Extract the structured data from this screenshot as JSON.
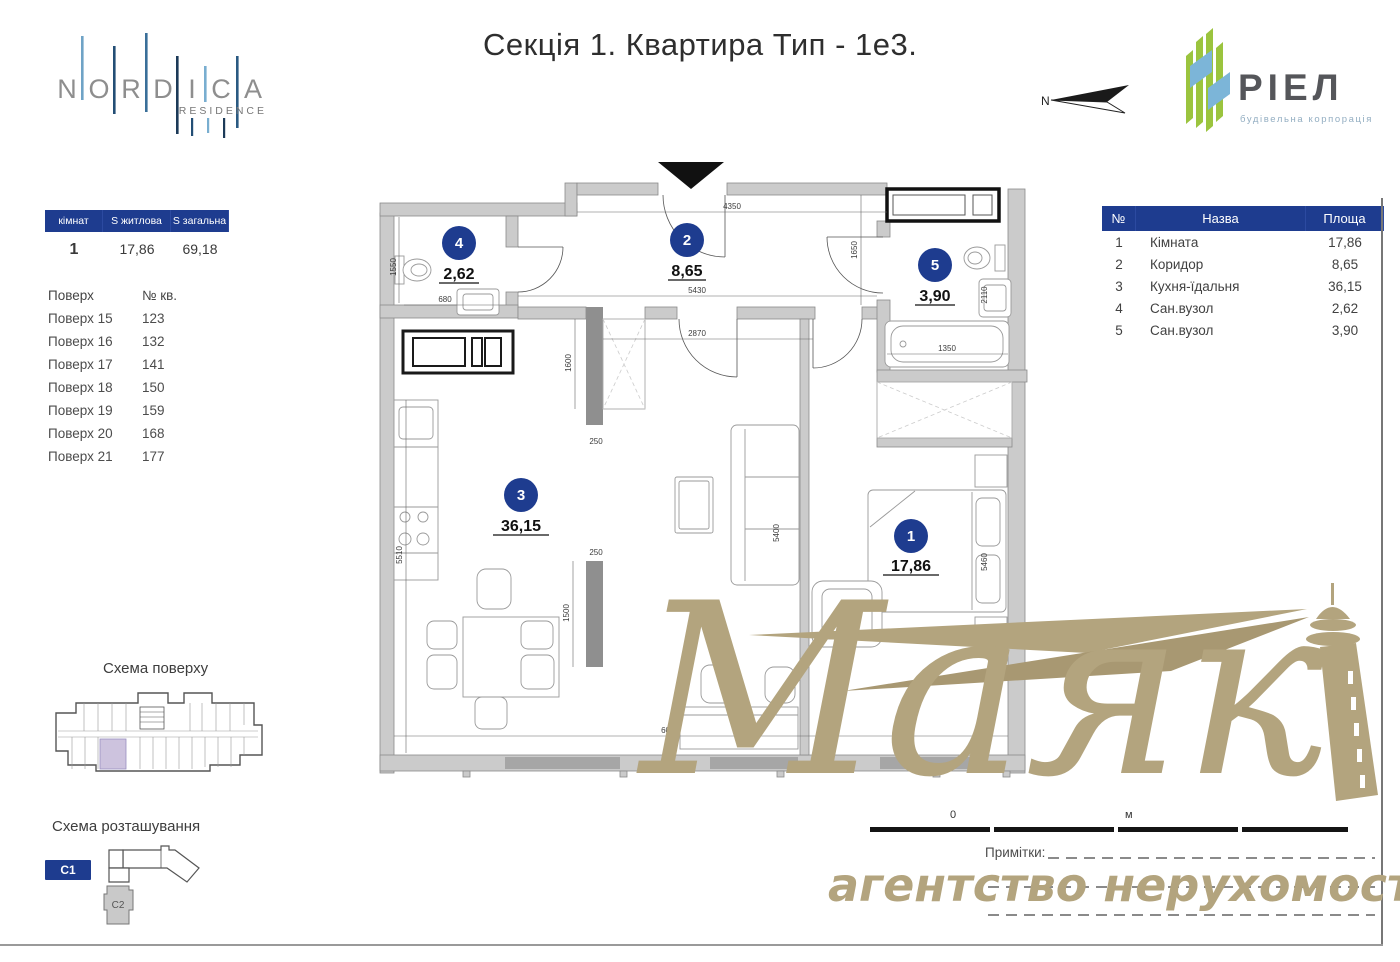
{
  "title": "Секція 1. Квартира Тип - 1е3.",
  "brand": {
    "nordica": {
      "letters": [
        "N",
        "O",
        "R",
        "D",
        "I",
        "C",
        "A"
      ],
      "sub": "RESIDENCE"
    },
    "riel": {
      "name": "РІЕЛ",
      "sub": "будівельна корпорація"
    },
    "compass": "N"
  },
  "summary": {
    "headers": [
      "кімнат",
      "S житлова",
      "S загальна"
    ],
    "row": [
      "1",
      "17,86",
      "69,18"
    ]
  },
  "floors": {
    "col1": "Поверх",
    "col2": "№ кв.",
    "rows": [
      [
        "Поверх 15",
        "123"
      ],
      [
        "Поверх 16",
        "132"
      ],
      [
        "Поверх 17",
        "141"
      ],
      [
        "Поверх 18",
        "150"
      ],
      [
        "Поверх 19",
        "159"
      ],
      [
        "Поверх 20",
        "168"
      ],
      [
        "Поверх 21",
        "177"
      ]
    ]
  },
  "rooms": {
    "headers": [
      "№",
      "Назва",
      "Площа"
    ],
    "rows": [
      [
        "1",
        "Кімната",
        "17,86"
      ],
      [
        "2",
        "Коридор",
        "8,65"
      ],
      [
        "3",
        "Кухня-їдальня",
        "36,15"
      ],
      [
        "4",
        "Сан.вузол",
        "2,62"
      ],
      [
        "5",
        "Сан.вузол",
        "3,90"
      ]
    ]
  },
  "plan": {
    "badges": [
      {
        "n": "1",
        "area": "17,86"
      },
      {
        "n": "2",
        "area": "8,65"
      },
      {
        "n": "3",
        "area": "36,15"
      },
      {
        "n": "4",
        "area": "2,62"
      },
      {
        "n": "5",
        "area": "3,90"
      }
    ],
    "dims": {
      "top": "4350",
      "corridor": "5430",
      "hall": "2870",
      "wc4_h": "1550",
      "wc4_w": "680",
      "wc5_h": "1650",
      "wc5_w": "2110",
      "bath": "1350",
      "ward_h": "1600",
      "stub1": "250",
      "stub2": "250",
      "stub_h": "1500",
      "kitchen_h": "5510",
      "living_h": "5400",
      "room1_h": "5460",
      "bottom": "6020"
    },
    "scale": {
      "zero": "0",
      "unit": "м"
    }
  },
  "schemes": {
    "floor_title": "Схема поверху",
    "location_title": "Схема розташування",
    "c1": "С1",
    "c2": "С2"
  },
  "watermark": {
    "name": "Маяк",
    "sub": "агентство нерухомості"
  },
  "notes": {
    "label": "Примітки:"
  },
  "colors": {
    "navy": "#1e3c8f",
    "tan": "#b3a47e",
    "wall": "#cbcbcb",
    "wall_dark": "#8f8f8f",
    "window": "#a6a6a6",
    "highlight": "#cdc3de",
    "riel_green": "#9bc43e",
    "riel_blue": "#7cb5d8"
  }
}
